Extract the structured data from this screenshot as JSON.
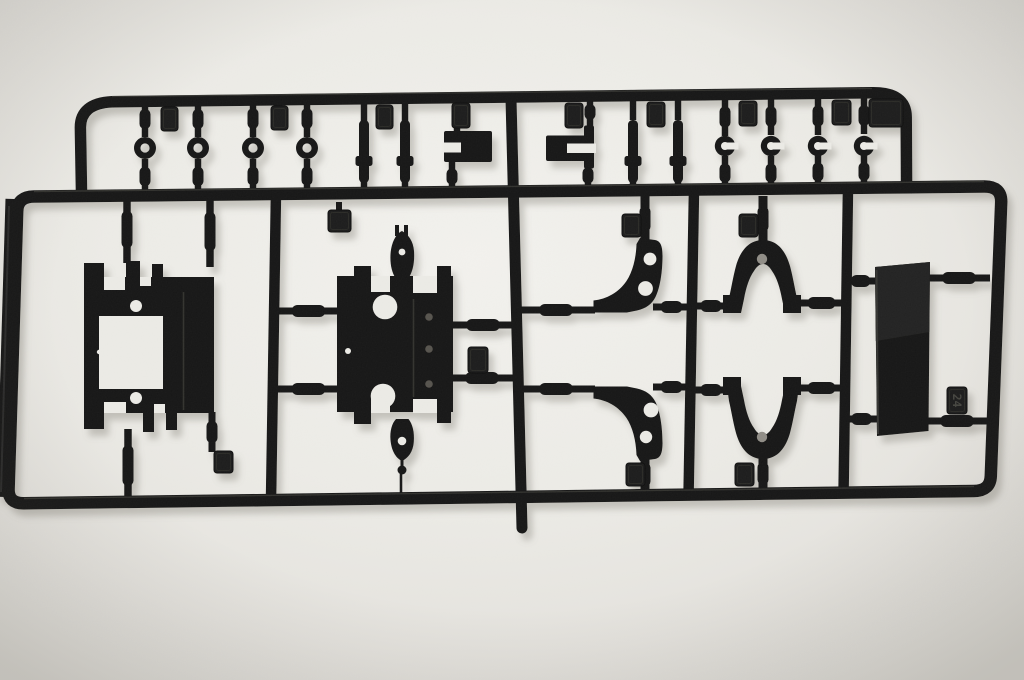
{
  "meta": {
    "type": "photograph",
    "subject": "Black injection-molded plastic model-kit sprue (parts runner) with suspension parts, photographed on an off-white surface",
    "visible_text": [
      "24"
    ]
  },
  "scene": {
    "canvas": {
      "width": 1024,
      "height": 680
    },
    "colors": {
      "plastic": "#161616",
      "plastic_dark": "#0e0e0e",
      "tab_face": "#1d1d1c",
      "tab_edge": "#111110",
      "emboss": "#2a2a28",
      "emboss_text": "#45443f",
      "bg_hole": "#ecebe6",
      "hole_shaded": "#908d86",
      "screw_dot": "#56534d",
      "gloss": "#4a4a45",
      "shadow": "#7e7a70",
      "bg_stops": [
        "#f3f2ee",
        "#edece7",
        "#e5e3de",
        "#d9d7d1"
      ]
    },
    "rails": [
      {
        "name": "top-runner-rail",
        "d": "M 81.5 192 L 80.4 128 Q 80 103.5 112 101.8 L 872 92.8 Q 906 92.2 906.2 117 L 906.6 189",
        "w": 11.5
      },
      {
        "name": "main-frame-rail",
        "d": "M 34 196.5 L 984 186.5 Q 1001.5 186.3 1001.2 202 L 990.8 476 Q 990.3 490.8 974 491 L 24 503.2 Q 8.2 503.6 8.6 489 L 17.2 211 Q 17.6 196.7 34 196.5 Z",
        "w": 12.5
      },
      {
        "name": "left-frame-edge",
        "d": "M 14 199 L 5.2 497",
        "w": 17
      },
      {
        "name": "divider-rail-1",
        "d": "M 276 192 L 271 500",
        "w": 10.5
      },
      {
        "name": "divider-rail-2",
        "d": "M 511 99 L 522 528",
        "w": 11,
        "cap": "round"
      },
      {
        "name": "divider-rail-3",
        "d": "M 694 190 L 688.5 497",
        "w": 10.5
      },
      {
        "name": "divider-rail-4",
        "d": "M 848 188 L 843.5 495",
        "w": 10.5
      }
    ],
    "hgates": [
      [
        277,
        340,
        311
      ],
      [
        277,
        340,
        389
      ],
      [
        453,
        513,
        325
      ],
      [
        451,
        513,
        378
      ],
      [
        517,
        595,
        310
      ],
      [
        653,
        690,
        307
      ],
      [
        517,
        595,
        389
      ],
      [
        653,
        690,
        387
      ],
      [
        693,
        729,
        306
      ],
      [
        798,
        845,
        303
      ],
      [
        693,
        729,
        390
      ],
      [
        798,
        845,
        388
      ],
      [
        844,
        877,
        281
      ],
      [
        928,
        990,
        278
      ],
      [
        844,
        879,
        419
      ],
      [
        926,
        988,
        421
      ]
    ],
    "vgates": [
      [
        145,
        101,
        137
      ],
      [
        198,
        101,
        137
      ],
      [
        253,
        100,
        137
      ],
      [
        307,
        100,
        137
      ],
      [
        145,
        159,
        194
      ],
      [
        198,
        159,
        194
      ],
      [
        253,
        159,
        193
      ],
      [
        307,
        159,
        193
      ],
      [
        364,
        99,
        122
      ],
      [
        405,
        99,
        122
      ],
      [
        364,
        181,
        193
      ],
      [
        405,
        181,
        193
      ],
      [
        457,
        99,
        131
      ],
      [
        452,
        162,
        191
      ],
      [
        590,
        98,
        126
      ],
      [
        588,
        161,
        190
      ],
      [
        633,
        98,
        120
      ],
      [
        678,
        98,
        120
      ],
      [
        633,
        182,
        192
      ],
      [
        678,
        182,
        192
      ],
      [
        725,
        98,
        136
      ],
      [
        771,
        98,
        135
      ],
      [
        818,
        97,
        135
      ],
      [
        864,
        97,
        134
      ],
      [
        725,
        156,
        190
      ],
      [
        771,
        156,
        190
      ],
      [
        818,
        155,
        189
      ],
      [
        864,
        155,
        188
      ],
      [
        127,
        196,
        263,
        7.5
      ],
      [
        210,
        196,
        267,
        7.5
      ],
      [
        128,
        429,
        502,
        7.5
      ],
      [
        212,
        412,
        452,
        7
      ],
      [
        339,
        202,
        212,
        6
      ],
      [
        645,
        196,
        242,
        9
      ],
      [
        645,
        453,
        496,
        9
      ],
      [
        763,
        196,
        242,
        9
      ],
      [
        763,
        453,
        494,
        9
      ],
      [
        401,
        474,
        500,
        2.6
      ]
    ],
    "washers": {
      "cy": 148,
      "cxs": [
        145,
        198,
        253,
        307
      ],
      "ring_r": 7.8,
      "ring_w": 6.4
    },
    "pins": {
      "xs": [
        364,
        405,
        633,
        678
      ],
      "y": 120,
      "h": 63,
      "w": 10,
      "collar_y": 156
    },
    "clips": {
      "cy": 146,
      "cxs": [
        725,
        771,
        818,
        864
      ],
      "outer_r": 10.2,
      "hole_r": 4
    },
    "tabs": [
      [
        161,
        107,
        17,
        24,
        ""
      ],
      [
        271,
        106,
        17,
        24,
        ""
      ],
      [
        376,
        105,
        17,
        24,
        ""
      ],
      [
        452,
        103,
        18,
        25,
        ""
      ],
      [
        565,
        103,
        18,
        25,
        ""
      ],
      [
        647,
        102,
        18,
        25,
        ""
      ],
      [
        739,
        101,
        18,
        25,
        ""
      ],
      [
        832,
        100,
        19,
        25,
        ""
      ],
      [
        869,
        99,
        34,
        28,
        ""
      ],
      [
        328,
        210,
        23,
        22,
        ""
      ],
      [
        214,
        451,
        19,
        22,
        ""
      ],
      [
        468,
        347,
        20,
        26,
        ""
      ],
      [
        622,
        214,
        19,
        23,
        ""
      ],
      [
        626,
        463,
        19,
        23,
        ""
      ],
      [
        739,
        214,
        19,
        23,
        ""
      ],
      [
        735,
        463,
        19,
        23,
        ""
      ],
      [
        947,
        387,
        20,
        27,
        "24"
      ]
    ],
    "parts": [
      {
        "name": "slotted-bracket-part",
        "rects": [
          [
            444,
            131,
            48,
            31,
            2
          ]
        ],
        "cuts": [
          [
            444,
            142.5,
            17,
            10
          ]
        ]
      },
      {
        "name": "fork-bracket-part",
        "rects": [
          [
            546,
            135.5,
            48,
            25.5,
            2
          ],
          [
            584,
            125.5,
            10,
            43,
            2
          ]
        ],
        "cuts": [
          [
            567,
            143.5,
            29,
            9.5
          ]
        ]
      },
      {
        "name": "chassis-plate-part",
        "rects": [
          [
            84,
            277,
            130,
            136
          ],
          [
            84,
            263,
            20,
            16
          ],
          [
            126,
            261,
            14,
            18
          ],
          [
            152,
            264,
            11,
            15
          ],
          [
            181,
            289,
            33,
            124
          ],
          [
            84,
            413,
            20,
            16
          ],
          [
            143,
            413,
            11,
            19
          ],
          [
            166,
            413,
            11,
            17
          ]
        ],
        "cuts": [
          [
            104,
            277,
            21,
            13
          ],
          [
            140,
            277,
            11,
            9
          ],
          [
            99,
            316,
            64,
            73
          ],
          [
            104,
            402,
            22,
            11
          ],
          [
            154,
            404,
            11,
            9
          ]
        ],
        "holes": [
          [
            136,
            306,
            6
          ],
          [
            136,
            398,
            6
          ],
          [
            99,
            352,
            2.2
          ]
        ],
        "lines": [
          [
            183.5,
            292,
            183.5,
            410,
            1.6,
            "#32312e"
          ]
        ]
      },
      {
        "name": "gearbox-chassis-part",
        "rects": [
          [
            337,
            276,
            116,
            136
          ],
          [
            354,
            266,
            17,
            12
          ],
          [
            437,
            266,
            14,
            12
          ],
          [
            412,
            297,
            39,
            102
          ],
          [
            354,
            412,
            17,
            12
          ],
          [
            437,
            412,
            14,
            11
          ],
          [
            395,
            225,
            4,
            11
          ],
          [
            404,
            225,
            4,
            11
          ]
        ],
        "paths": [
          {
            "d": "M 402 231 C 395.5 234 391.5 243 390.6 253 C 389.8 263 391.5 272 395.5 278 L 408.5 278 C 412.8 272 414.8 262 414 251 C 413.2 241 408.5 234.5 402 231 Z"
          },
          {
            "d": "M 402 461 C 395.5 458 391.3 450 390.5 440 C 389.8 431 391.8 423.5 396 419 L 408.5 419 C 412.5 424 414.6 432 413.8 442 C 413 452 408.3 458 402 461 Z"
          }
        ],
        "cuts": [
          [
            371,
            276,
            19,
            16
          ],
          [
            413,
            276,
            24,
            17
          ],
          [
            371,
            398,
            19,
            15
          ],
          [
            413,
            399,
            24,
            14
          ]
        ],
        "holes": [
          [
            402,
            252,
            3.4
          ],
          [
            385,
            307,
            12.3
          ],
          [
            383,
            396,
            12.3
          ],
          [
            348,
            351,
            3
          ],
          [
            402,
            441,
            4.3
          ]
        ],
        "dots": [
          [
            429,
            317,
            3.8,
            "#56534d"
          ],
          [
            429,
            349,
            3.8,
            "#56534d"
          ],
          [
            429,
            384,
            3.8,
            "#56534d"
          ],
          [
            402,
            470,
            4.5
          ]
        ],
        "lines": [
          [
            402,
            460,
            402,
            467,
            3
          ],
          [
            413.5,
            299,
            413.5,
            397,
            1.6,
            "#32312e"
          ]
        ]
      },
      {
        "name": "caster-arm-upper-part",
        "paths": [
          {
            "d": "M 640 238 L 655 240 C 661 241 662.5 247 662.5 256 C 662.5 272 660 288 655.5 297 C 652 304 646 308.5 637 310.5 L 627 312.5 L 593.5 312.5 L 593.5 300.5 C 607 299 618.5 292.5 626.5 281 C 632.5 272 636 259 636.5 244 Z"
          }
        ],
        "holes": [
          [
            650,
            259,
            6.4
          ],
          [
            645.5,
            288.5,
            7.4
          ]
        ]
      },
      {
        "name": "caster-arm-lower-part",
        "paths": [
          {
            "d": "M 640 461 L 655 459 C 661 458 662.5 452 662.5 443 C 662.5 427 660 411 655.5 402 C 652 395 646 390.5 637 388.5 L 627 386.5 L 593.5 386.5 L 593.5 398.5 C 607 400 618.5 406.5 626.5 418 C 632.5 427 636 440 636.5 455 Z"
          }
        ],
        "holes": [
          [
            651,
            410,
            7.4
          ],
          [
            646,
            437,
            6.2
          ]
        ]
      },
      {
        "name": "wishbone-upper-part",
        "rects": [
          [
            723,
            295,
            18,
            18
          ],
          [
            783,
            295,
            18,
            18
          ]
        ],
        "paths": [
          {
            "d": "M 763 240 C 748 240 740 252 736 266 C 733 277 731 290 729 298 L 727 313 L 741 313 L 744 299 C 746 288 749 278 754 271 C 757 266 760 264 763 264 C 766 264 769 266 772 271 C 777 278 780 288 782 299 L 785 313 L 799 313 L 797 298 C 795 290 793 277 790 266 C 786 252 778 240 763 240 Z"
          }
        ],
        "dots": [
          [
            762,
            259,
            5.2,
            "#908d86"
          ]
        ]
      },
      {
        "name": "wishbone-lower-part",
        "rects": [
          [
            723,
            377,
            18,
            18
          ],
          [
            783,
            377,
            18,
            18
          ]
        ],
        "paths": [
          {
            "d": "M 763 459 C 748 459 740 447 736 433 C 733 422 731 409 729 401 L 727 386 L 741 386 L 744 400 C 746 411 749 421 754 428 C 757 433 760 435 763 435 C 766 435 769 433 772 428 C 777 421 780 411 782 400 L 785 386 L 799 386 L 797 401 C 795 409 793 422 790 433 C 786 447 778 459 763 459 Z"
          }
        ],
        "dots": [
          [
            762,
            437,
            5.2,
            "#908d86"
          ]
        ]
      },
      {
        "name": "battery-plate-part",
        "polys": [
          {
            "pts": "875,267 930,262 928.5,431 877,436",
            "fill": "#191918"
          },
          {
            "pts": "875,267 930,262 929.3,332 875.8,341",
            "fill": "#232321"
          }
        ],
        "lines": [
          [
            876.5,
            270,
            878,
            434,
            2,
            "#343432"
          ]
        ]
      }
    ],
    "highlights": [
      [
        34,
        191.5,
        984,
        181.5,
        1.4,
        "#4a4a45",
        0.55
      ],
      [
        24,
        498.5,
        974,
        486.5,
        1.4,
        "#4a4a45",
        0.5
      ],
      [
        112,
        96.5,
        872,
        88.5,
        1.3,
        "#4a4a45",
        0.5
      ],
      [
        9,
        206,
        1,
        492,
        2,
        "#3c3b37",
        0.6
      ]
    ]
  }
}
